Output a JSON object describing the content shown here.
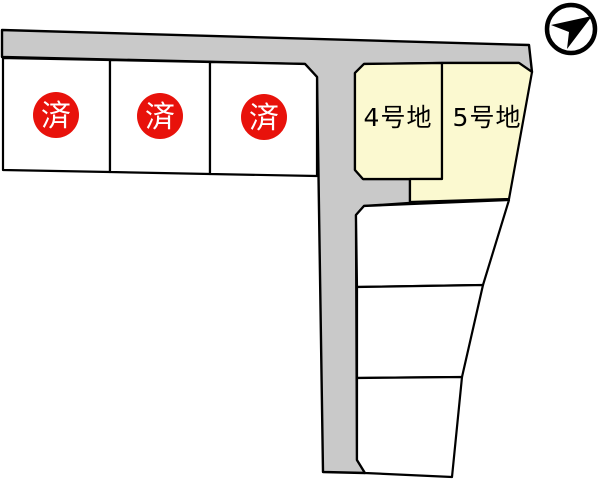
{
  "colors": {
    "background": "#ffffff",
    "road": "#c9c9c9",
    "sold_lot_fill": "#ffffff",
    "available_lot_fill": "#fbf9d0",
    "vacant_lot_fill": "#ffffff",
    "outline": "#000000",
    "sold_badge": "#e8120b",
    "sold_badge_text": "#ffffff",
    "lot_label_text": "#000000",
    "compass": "#000000"
  },
  "lots": {
    "sold": [
      {
        "label": "済"
      },
      {
        "label": "済"
      },
      {
        "label": "済"
      }
    ],
    "available": [
      {
        "label": "4号地"
      },
      {
        "label": "5号地"
      }
    ],
    "vacant_unlabeled_count": "3"
  },
  "icons": {
    "north_arrow": "compass-north-arrow"
  }
}
